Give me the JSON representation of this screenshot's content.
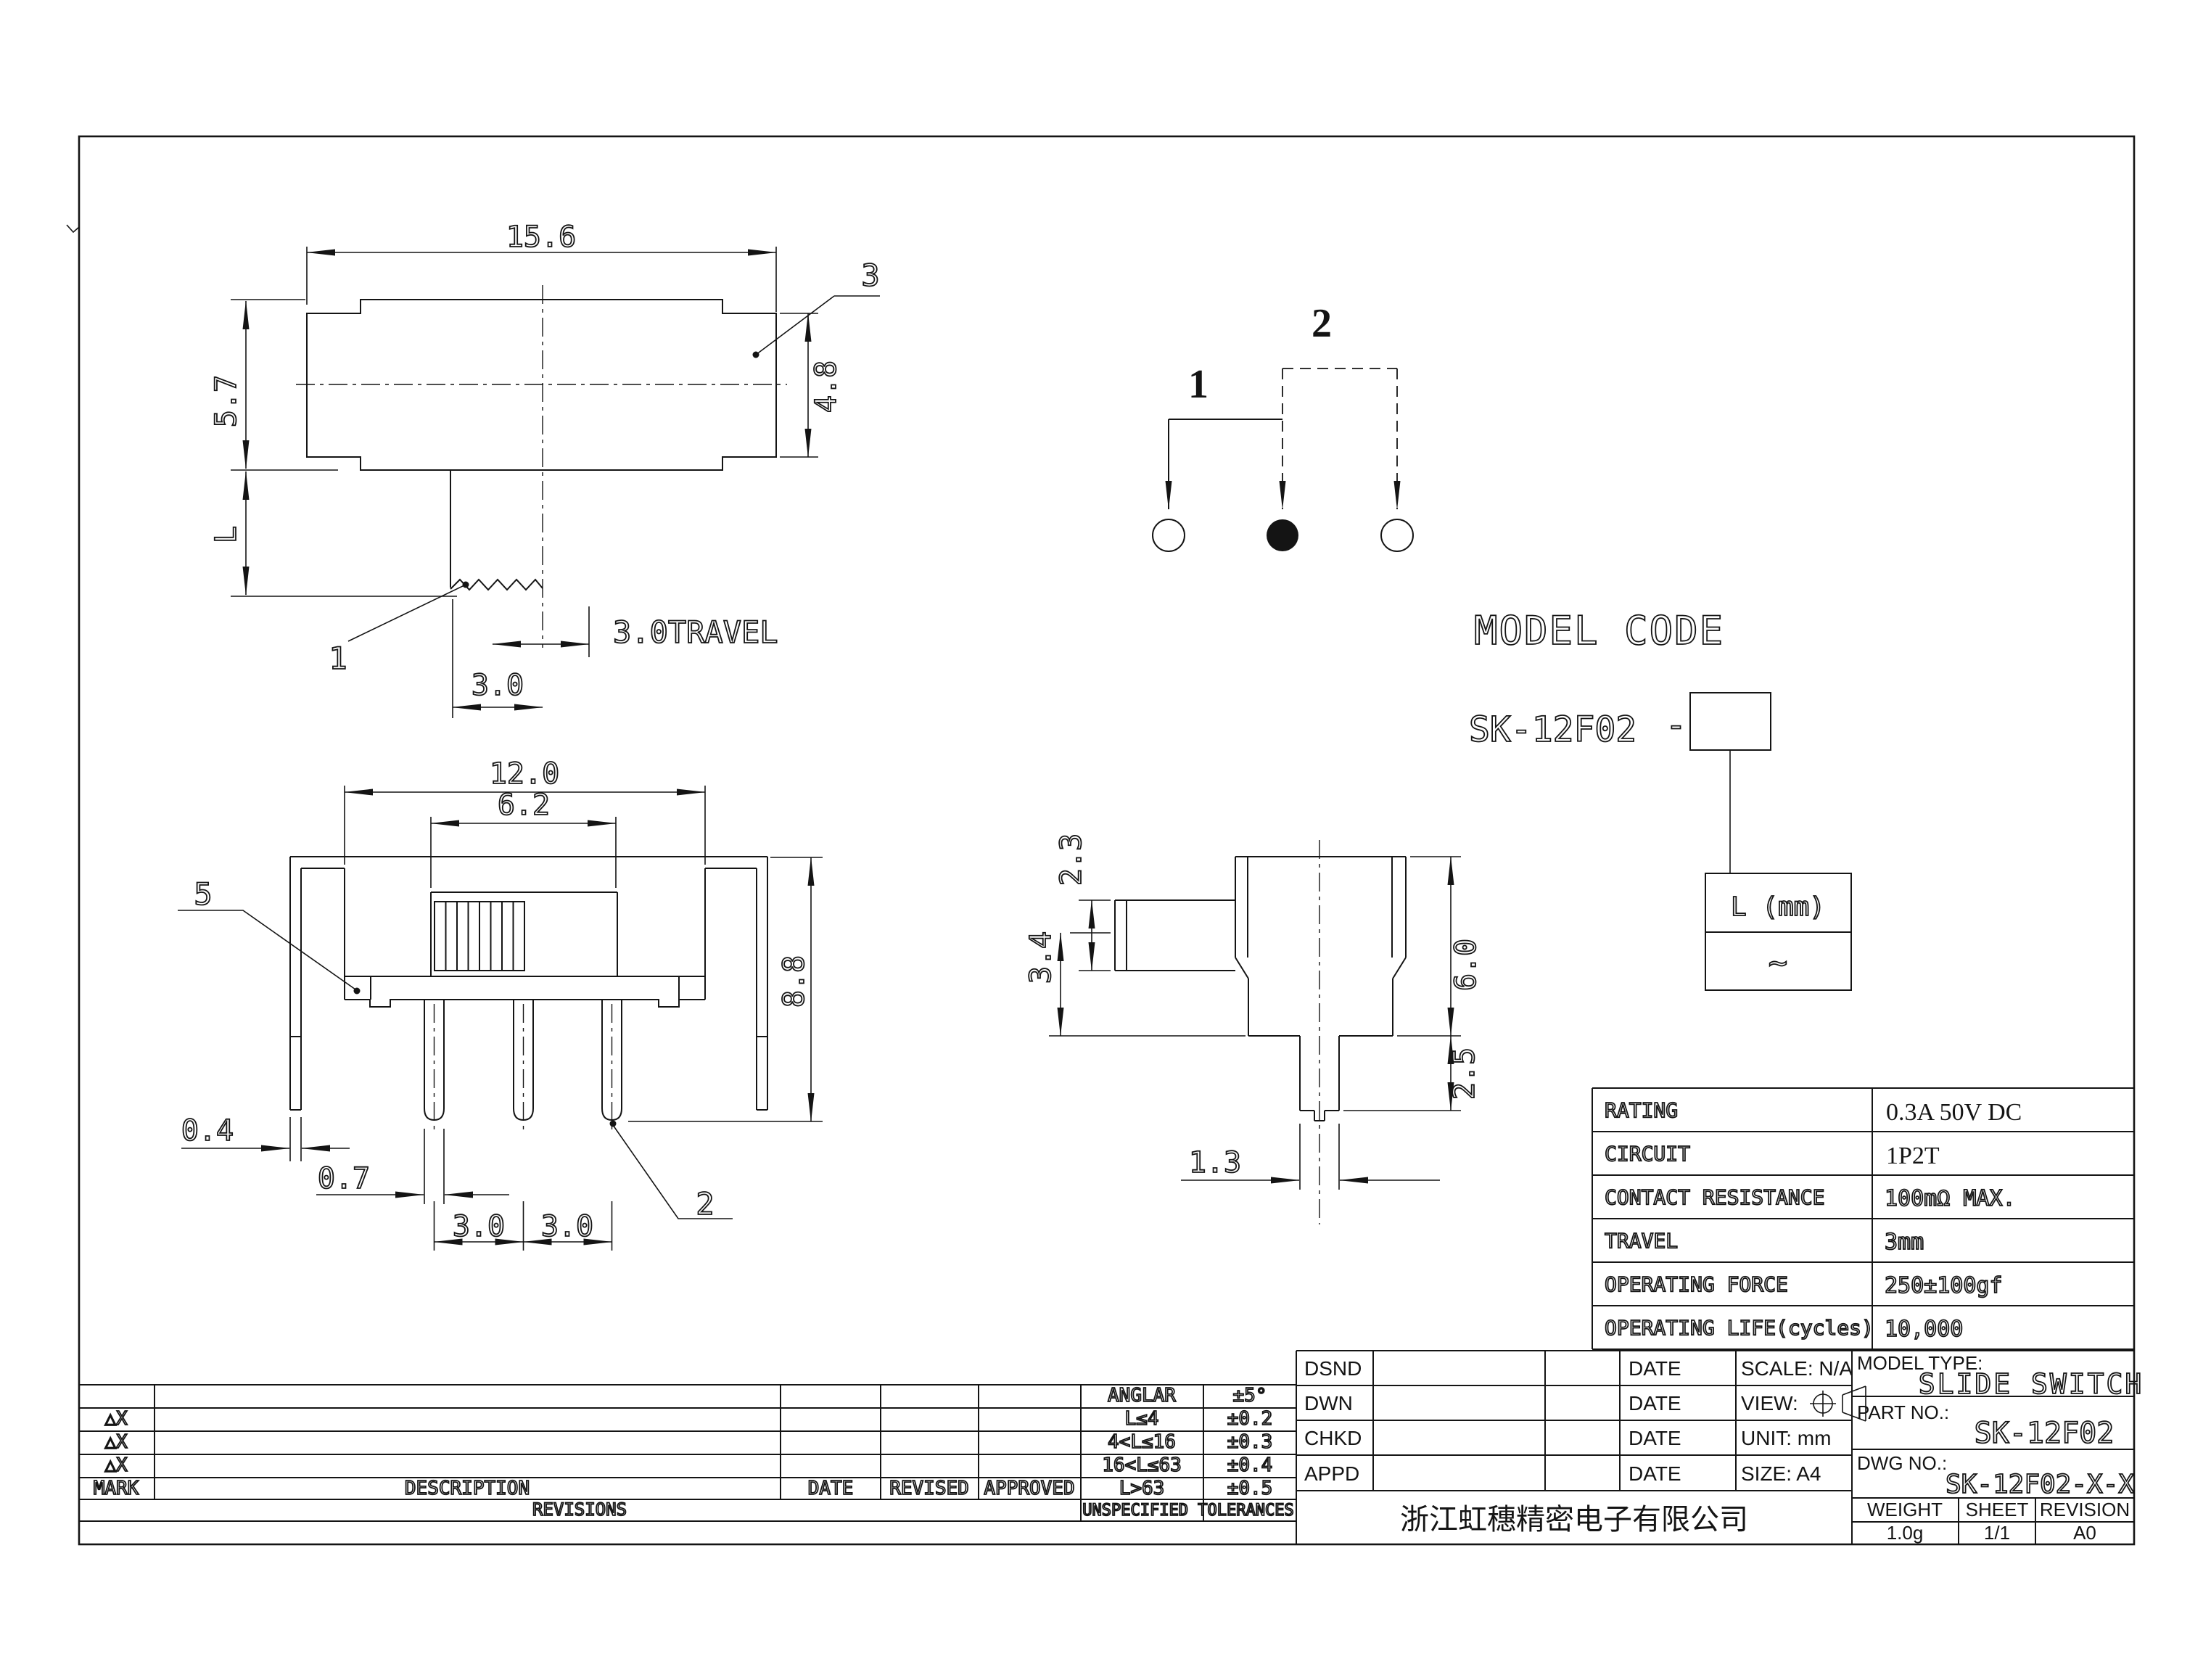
{
  "top_view": {
    "dims": {
      "width": "15.6",
      "height_left": "5.7",
      "length": "L",
      "height_right": "4.8",
      "travel": "3.0TRAVEL",
      "knob_offset": "3.0"
    },
    "callouts": {
      "knob": "1",
      "body": "3"
    }
  },
  "circuit_diagram": {
    "pos1": "1",
    "pos2": "2"
  },
  "model_code": {
    "title": "MODEL CODE",
    "base_code": "SK-12F02",
    "separator": "-",
    "length_cell": "L (mm)",
    "range_cell": "~"
  },
  "front_view": {
    "dims": {
      "width": "12.0",
      "slot": "6.2",
      "height": "8.8",
      "bracket": "0.4",
      "pin_width": "0.7",
      "pitch_left": "3.0",
      "pitch_right": "3.0"
    },
    "callouts": {
      "bracket": "5",
      "pin": "2"
    }
  },
  "side_view": {
    "dims": {
      "knob": "2.3",
      "step": "3.4",
      "body": "6.0",
      "pin_length": "2.5",
      "pin_width": "1.3"
    }
  },
  "spec_table": {
    "rows": [
      {
        "label": "RATING",
        "value": "0.3A 50V DC"
      },
      {
        "label": "CIRCUIT",
        "value": "1P2T"
      },
      {
        "label": "CONTACT RESISTANCE",
        "value": "100mΩ MAX."
      },
      {
        "label": "TRAVEL",
        "value": "3mm"
      },
      {
        "label": "OPERATING FORCE",
        "value": "250±100gf"
      },
      {
        "label": "OPERATING LIFE(cycles)",
        "value": "10,000"
      }
    ]
  },
  "tolerance_table": {
    "marks": [
      "△X",
      "△X",
      "△X"
    ],
    "headers": {
      "mark": "MARK",
      "description": "DESCRIPTION",
      "date": "DATE",
      "revised": "REVISED",
      "approved": "APPROVED"
    },
    "revisions_label": "REVISIONS",
    "unspecified_label": "UNSPECIFIED TOLERANCES",
    "rows": [
      {
        "range": "ANGLAR",
        "tol": "±5°"
      },
      {
        "range": "L≤4",
        "tol": "±0.2"
      },
      {
        "range": "4<L≤16",
        "tol": "±0.3"
      },
      {
        "range": "16<L≤63",
        "tol": "±0.4"
      },
      {
        "range": "L>63",
        "tol": "±0.5"
      }
    ]
  },
  "title_block": {
    "rows": [
      {
        "label": "DSND",
        "date": "DATE"
      },
      {
        "label": "DWN",
        "date": "DATE"
      },
      {
        "label": "CHKD",
        "date": "DATE"
      },
      {
        "label": "APPD",
        "date": "DATE"
      }
    ],
    "scale": "SCALE: N/A",
    "view": "VIEW:",
    "unit": "UNIT: mm",
    "size": "SIZE: A4",
    "model_type_label": "MODEL TYPE:",
    "model_type": "SLIDE SWITCH",
    "part_no_label": "PART NO.:",
    "part_no": "SK-12F02",
    "dwg_no_label": "DWG NO.:",
    "dwg_no": "SK-12F02-X-X",
    "weight_label": "WEIGHT",
    "sheet_label": "SHEET",
    "revision_label": "REVISION",
    "weight": "1.0g",
    "sheet": "1/1",
    "revision": "A0",
    "company": "浙江虹穗精密电子有限公司"
  }
}
